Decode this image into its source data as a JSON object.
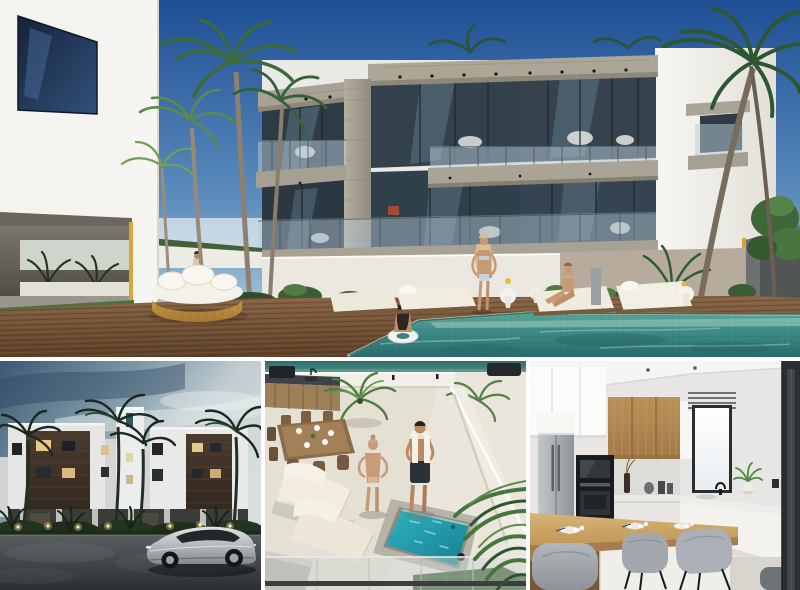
{
  "collage": {
    "title": "New-build apartment project render collage",
    "panels": {
      "main_exterior": {
        "description": "Hero 3D render: white three-storey apartment building with stone-clad balcony frames and glass railings, tall palm trees, wooden pool deck with round rattan daybed, white sun loungers, people sunbathing and a woman floating on a ring in a turquoise swimming pool under a deep blue sky"
      },
      "street_exterior": {
        "description": "Dusk street render: white apartment block with dark timber facade panels and warm lit windows, central stair tower, palm silhouettes, garden path lights, and a silver sedan parked on the dark asphalt road"
      },
      "roof_terrace": {
        "description": "Rooftop terrace render seen from above: couple standing beside a turquoise plunge pool, white loungers, timber dining set, outdoor kitchen with grill, potted palms and glass balustrade"
      },
      "kitchen_interior": {
        "description": "Interior render of a modern kitchen: timber and white cabinets, stainless fridge, black built-in oven and microwave, bright window with blinds, timber breakfast bar with place settings and grey upholstered stools"
      }
    },
    "palette": {
      "sky_blue": "#1e4e95",
      "sky_horizon": "#c2d8e4",
      "pool_teal": "#3f8d88",
      "pool_light": "#a8cfc4",
      "deck_brown": "#7a5a3c",
      "stone_grey": "#a7a294",
      "wall_white": "#f2f1ec",
      "accent_gold": "#d9a53f",
      "dusk_sky": "#3b5872",
      "timber_panel": "#4a3b2d",
      "lit_window": "#e8c887",
      "road_asphalt": "#2c2f32",
      "car_silver": "#c6cacd",
      "plunge_pool": "#2aa2b2",
      "terrace_floor": "#e5e0d4",
      "cabinet_wood": "#b58c58",
      "appliance_black": "#191c1f",
      "stool_grey": "#a2a8ad"
    }
  }
}
